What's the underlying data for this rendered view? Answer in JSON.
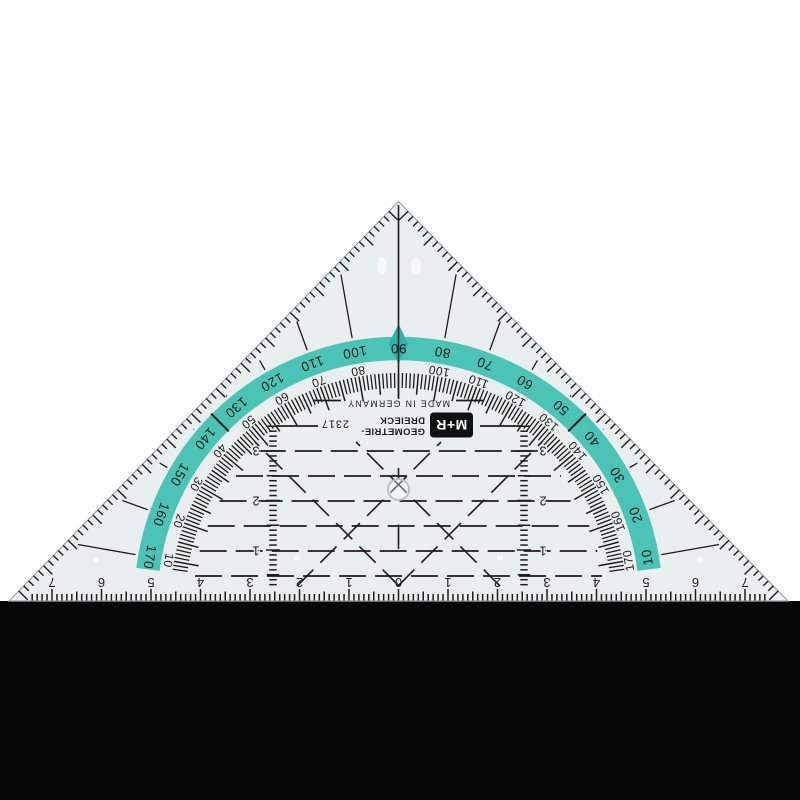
{
  "product": {
    "logo_text": "M+R",
    "name_line1": "GEOMETRIE-",
    "name_line2": "DREIECK",
    "model": "2317",
    "origin": "MADE IN GERMANY"
  },
  "protractor": {
    "outer_scale_degrees": [
      10,
      20,
      30,
      40,
      50,
      60,
      70,
      80,
      90,
      100,
      110,
      120,
      130,
      140,
      150,
      160,
      170
    ],
    "inner_scale_degrees": [
      170,
      160,
      150,
      140,
      130,
      120,
      110,
      100,
      "",
      80,
      70,
      60,
      50,
      40,
      30,
      20,
      10
    ],
    "fine_tick_step_degrees": 1,
    "cross_mark_degrees": [
      45,
      135
    ]
  },
  "ruler": {
    "unit_numbers": [
      7,
      6,
      5,
      4,
      3,
      2,
      1,
      0,
      1,
      2,
      3,
      4,
      5,
      6,
      7
    ]
  },
  "parallel_lines": {
    "labels": [
      1,
      2,
      3
    ]
  },
  "colors": {
    "background": "#ffffff",
    "base_shadow": "#070707",
    "surface": "#e9efee",
    "edge": "#9aa5a3",
    "band": "#4cc3b7",
    "band_accent": "#2db3a8",
    "ink": "#1d1d1b",
    "hole_ring": "#b7c2c0",
    "nub": "#f6faf9"
  }
}
